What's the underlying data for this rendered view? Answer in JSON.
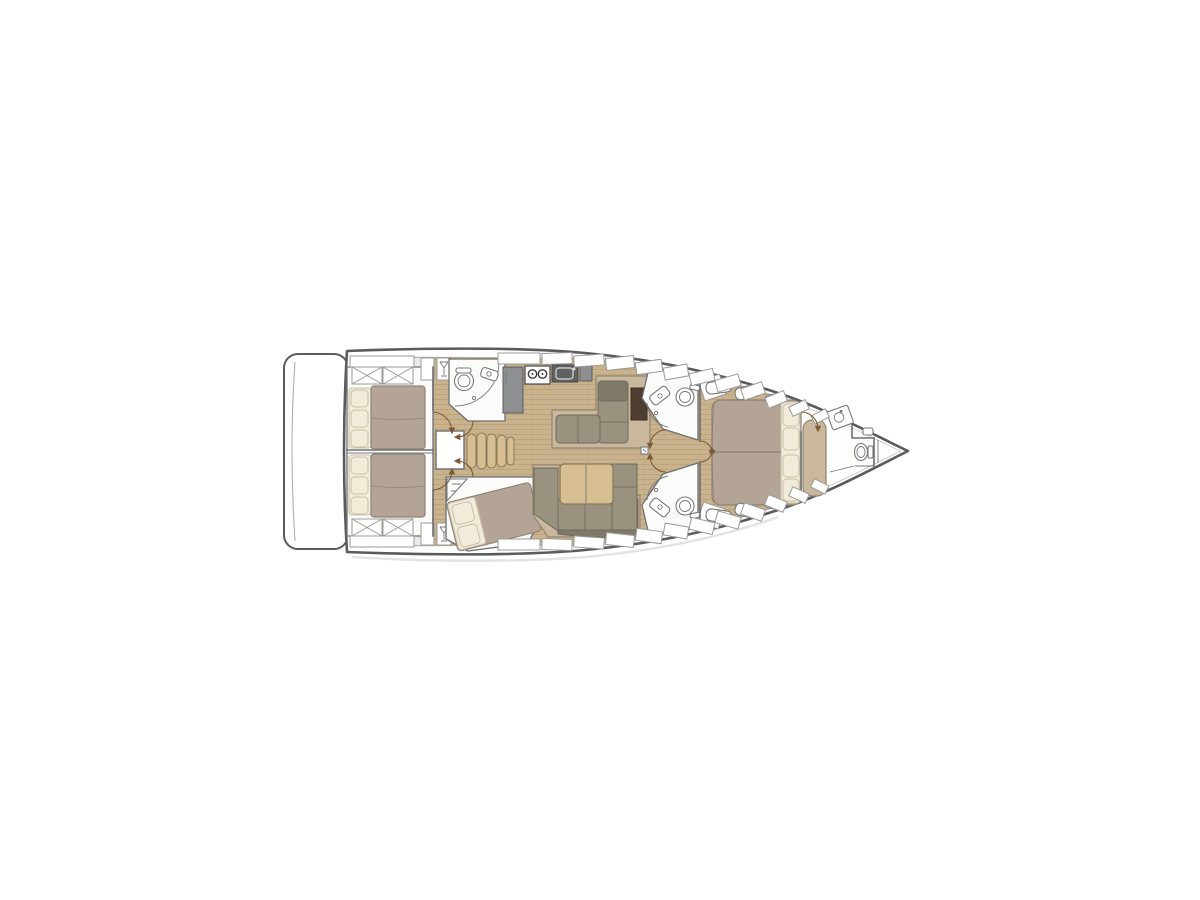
{
  "page": {
    "title": "Sailing yacht interior floor plan",
    "background": "#ffffff",
    "orientation": "bow-right",
    "view": "top-down deck plan"
  },
  "colors": {
    "hull_stroke": "#5a5b5e",
    "line_light": "#a8a8a5",
    "wall": "#6e6f71",
    "deck": "#ebebe8",
    "room": "#fbfbf9",
    "wood": "#c9b28c",
    "plank": "#b7a17d",
    "duvet": "#b3a496",
    "duvet_line": "#8f8276",
    "pillow": "#f1ebda",
    "pillow_line": "#c9c0a8",
    "sofa": "#98927f",
    "sofa_dark": "#7f7968",
    "sofa_line": "#6e695c",
    "counter": "#8d8f90",
    "counter_dark": "#5f6163",
    "table_wood": "#d6bd92",
    "dark_wood": "#4e3e2f",
    "tan": "#c9b89e",
    "fix_line": "#77787a",
    "door": "#7d5a36",
    "window_line": "#9b9b98",
    "x_line": "#9b9b98",
    "shadow": "#d8d8d5"
  },
  "vessel": {
    "rooms": [
      {
        "id": "swim-platform",
        "label": "stern swim platform"
      },
      {
        "id": "aft-cabin-port",
        "label": "aft double cabin (top)",
        "furniture": [
          "double berth",
          "3 pillows",
          "overhead lockers with X fronts"
        ]
      },
      {
        "id": "aft-cabin-starboard",
        "label": "aft double cabin (bottom)",
        "furniture": [
          "double berth",
          "3 pillows",
          "overhead lockers with X fronts"
        ]
      },
      {
        "id": "companionway",
        "label": "companionway",
        "furniture": [
          "engine box",
          "4 curved steps"
        ]
      },
      {
        "id": "aft-head",
        "label": "aft head with shower",
        "fixtures": [
          "toilet",
          "vanity sink",
          "curved shower screen"
        ]
      },
      {
        "id": "third-cabin",
        "label": "angled bunk cabin (bottom left of salon)",
        "furniture": [
          "angled double berth",
          "2 pillows",
          "corner shelf"
        ]
      },
      {
        "id": "galley",
        "label": "galley",
        "fixtures": [
          "refrigerator counter",
          "two-burner stove",
          "sink unit",
          "worktop"
        ]
      },
      {
        "id": "salon-settee",
        "label": "L-shaped salon settee with chart table",
        "furniture": [
          "L sofa",
          "dark chart table"
        ]
      },
      {
        "id": "dinette",
        "label": "dinette",
        "furniture": [
          "wood saloon table",
          "U-shaped sofa"
        ]
      },
      {
        "id": "mid-head-port",
        "label": "forward head (top)",
        "fixtures": [
          "toilet",
          "angled sink",
          "shower arc",
          "louvered locker"
        ]
      },
      {
        "id": "mid-head-starboard",
        "label": "forward head (bottom)",
        "fixtures": [
          "toilet",
          "angled sink",
          "shower arc",
          "louvered locker"
        ]
      },
      {
        "id": "owner-cabin",
        "label": "owner cabin forward",
        "furniture": [
          "island double berth",
          "4 pillows",
          "side shelves",
          "tan bench seat"
        ]
      },
      {
        "id": "forward-head",
        "label": "bow head",
        "fixtures": [
          "vanity sink",
          "toilet",
          "shower partitions"
        ]
      },
      {
        "id": "bow-locker",
        "label": "bow tip locker"
      }
    ],
    "deck_features": [
      "segmented hull windows along both sides",
      "louvered vent lockers",
      "glass-rack lockers",
      "mast step square in corridor",
      "door swing arrows"
    ]
  }
}
